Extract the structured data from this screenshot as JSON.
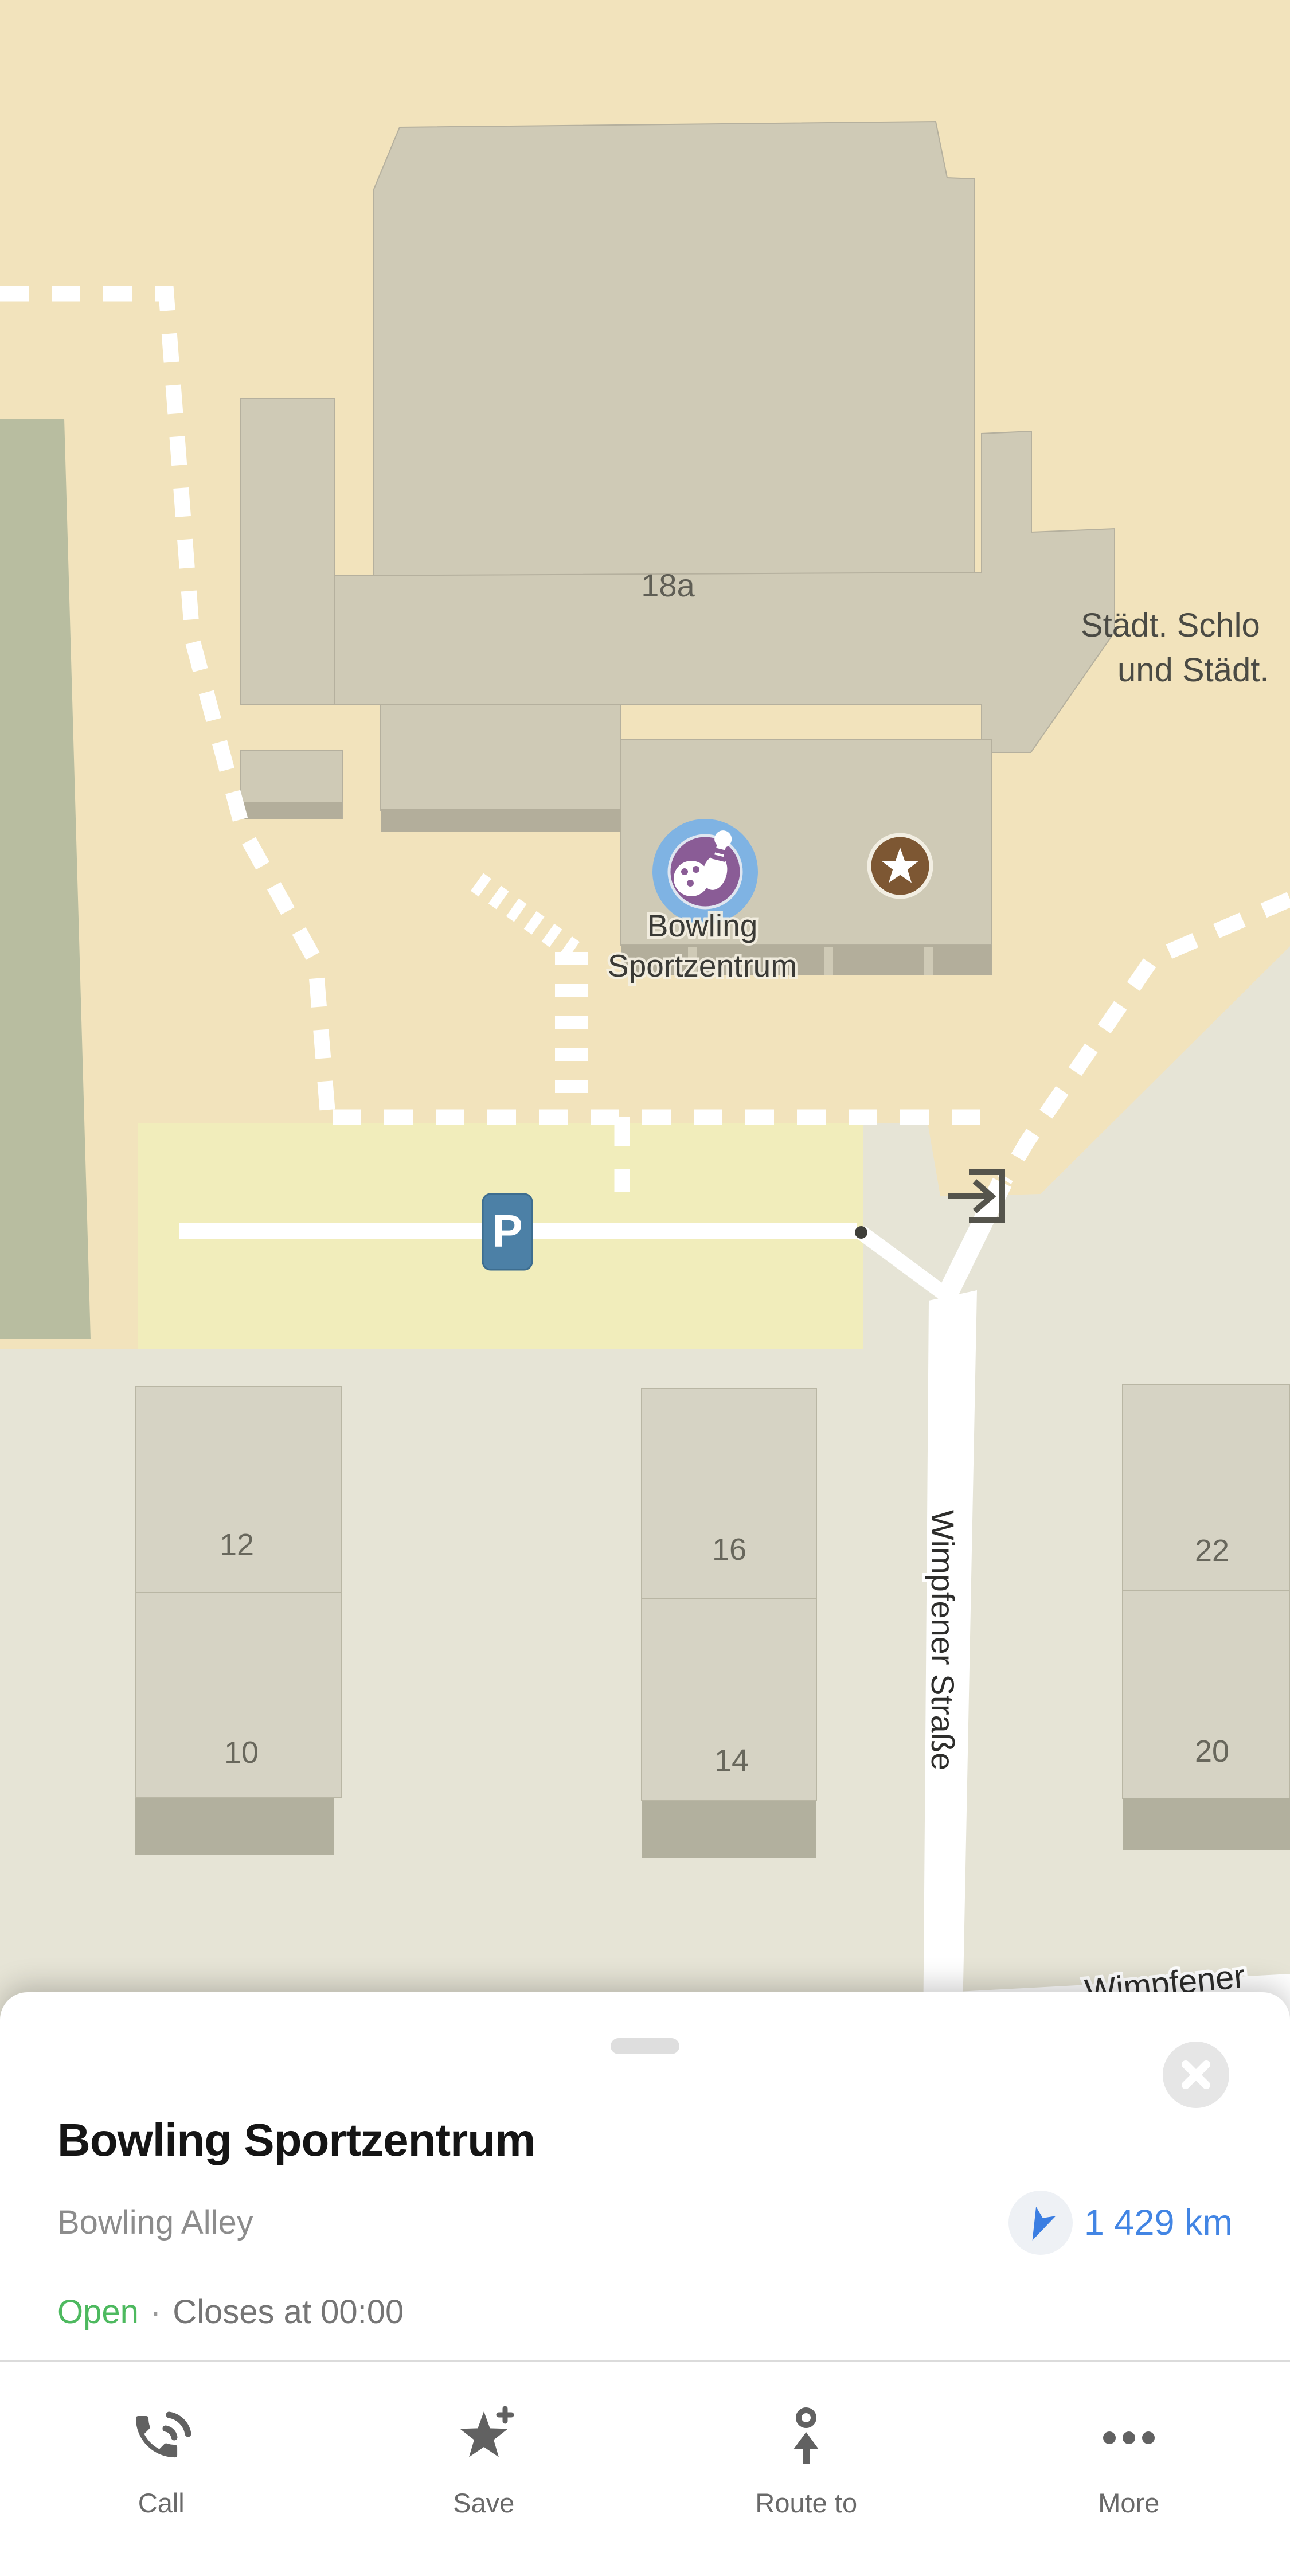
{
  "map": {
    "building_number": "18a",
    "clipped_label_line1": "Städt. Schlo",
    "clipped_label_line2": "und Städt.",
    "poi_label_line1": "Bowling",
    "poi_label_line2": "Sportzentrum",
    "parking_label": "P",
    "house_numbers": [
      "12",
      "10",
      "16",
      "14",
      "22",
      "20"
    ],
    "street_label_vertical": "Wimpfener Straße",
    "street_label_bottom": "Wimpfener",
    "icons": {
      "poi": "bowling-icon",
      "favorite": "star-icon",
      "parking": "parking-icon",
      "entrance": "entrance-arrow-icon"
    },
    "colors": {
      "background": "#f2e3bc",
      "building_upper": "#cfcab6",
      "building_lower_row": "#d6d3c4",
      "building_shadow": "#b3ae9b",
      "parking_area": "#f1edbb",
      "ground": "#e6e4d6",
      "vegetation": "#b8bda0",
      "road": "#ffffff",
      "poi_badge_blue": "#7fb3e3",
      "poi_badge_purple": "#8a5c96",
      "favorite_brown": "#7d5733",
      "parking_marker_blue": "#4c80a6"
    }
  },
  "sheet": {
    "title": "Bowling Sportzentrum",
    "category": "Bowling Alley",
    "distance": "1 429 km",
    "distance_icon": "navigation-arrow-icon",
    "close_icon": "close-icon",
    "status": {
      "open": "Open",
      "separator": "·",
      "closes": "Closes at 00:00"
    },
    "colors": {
      "open_green": "#4db95f",
      "distance_blue": "#4285e4"
    },
    "actions": [
      {
        "label": "Call",
        "icon": "phone-icon"
      },
      {
        "label": "Save",
        "icon": "star-plus-icon"
      },
      {
        "label": "Route to",
        "icon": "route-arrow-icon"
      },
      {
        "label": "More",
        "icon": "more-dots-icon"
      }
    ]
  }
}
